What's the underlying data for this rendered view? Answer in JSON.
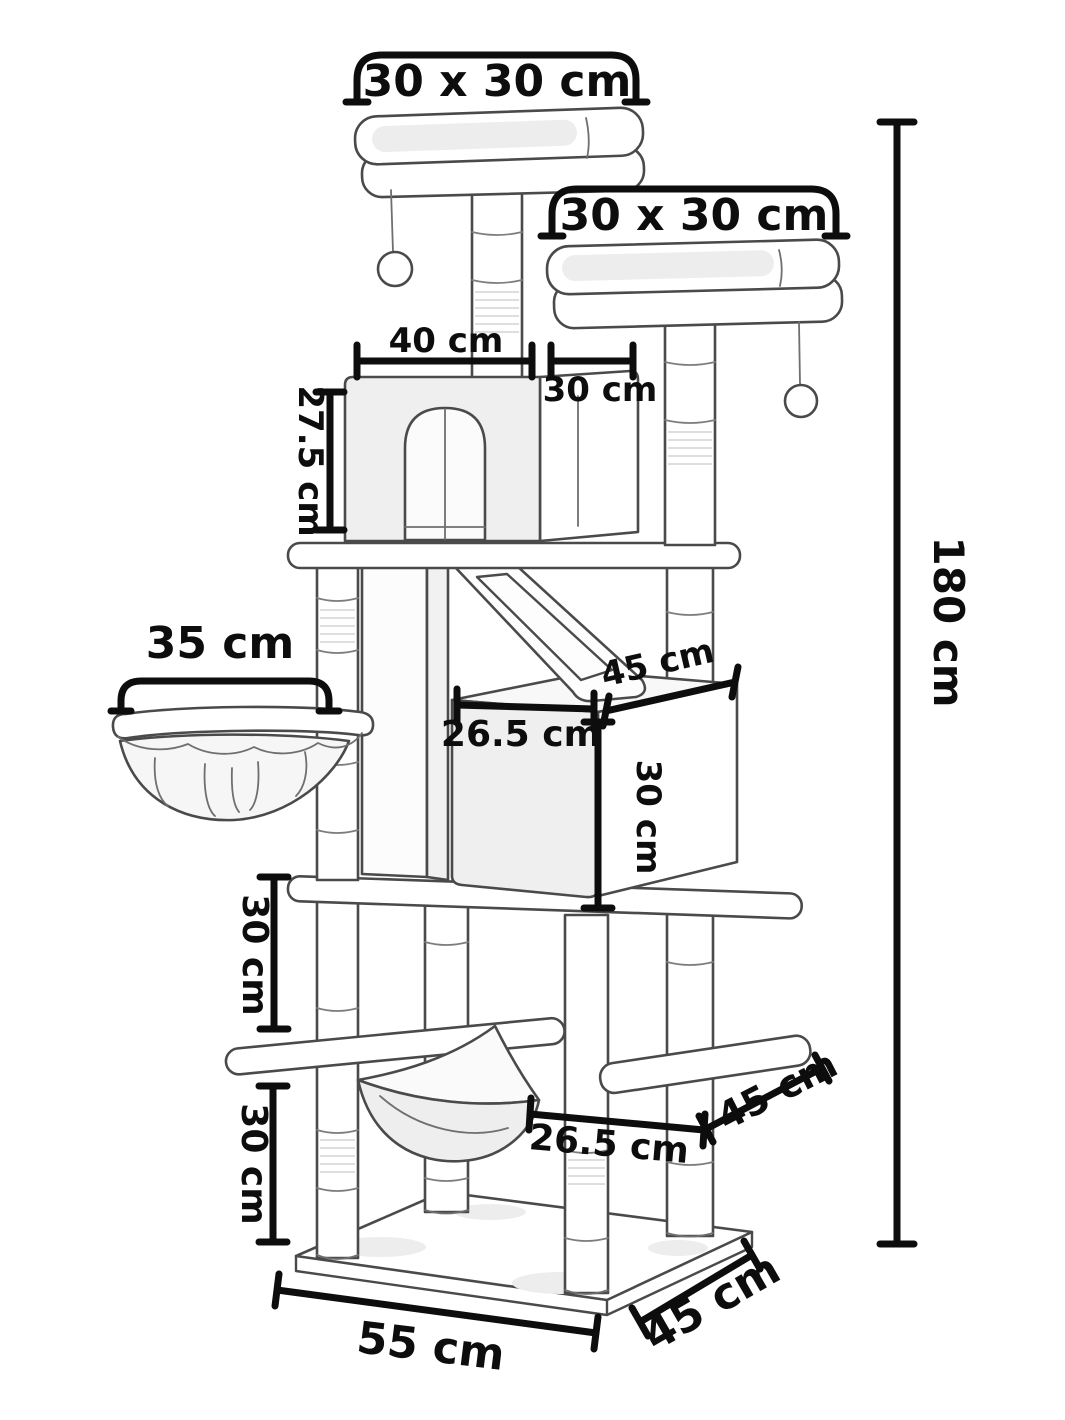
{
  "diagram": {
    "type": "product-dimension-diagram",
    "subject": "Cat tree",
    "unit": "cm",
    "colors": {
      "background": "#ffffff",
      "line": "#4a4a4a",
      "dimension": "#0d0d0d",
      "shading": "#ededed"
    },
    "labels": {
      "top_perch_size": "30 x 30 cm",
      "upper_perch_size": "30 x 30 cm",
      "house_width": "40 cm",
      "house_depth": "30 cm",
      "house_height": "27.5 cm",
      "basket_width": "35 cm",
      "condo_depth": "45 cm",
      "condo_width": "26.5 cm",
      "condo_height": "30 cm",
      "upper_level_gap": "30 cm",
      "lower_level_gap": "30 cm",
      "mid_platform_depth": "45 cm",
      "hammock_width": "26.5 cm",
      "total_height": "180 cm",
      "base_width": "55 cm",
      "base_depth": "45 cm"
    }
  }
}
